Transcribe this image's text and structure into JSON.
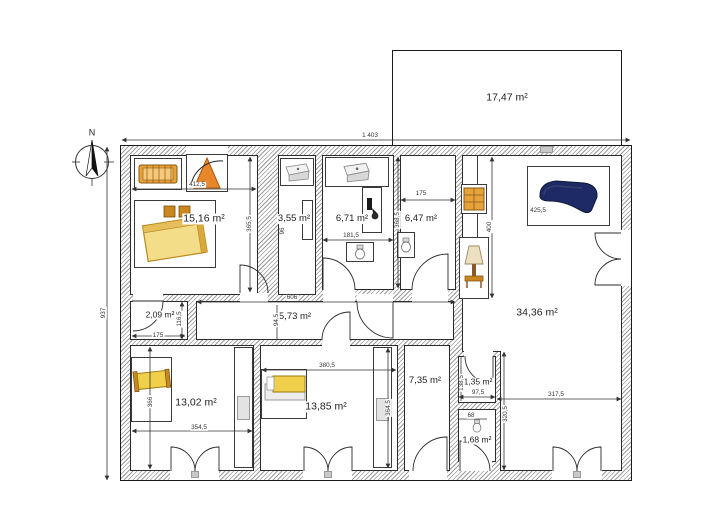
{
  "compass": {
    "north_label": "N"
  },
  "rooms": {
    "top_room": {
      "area": "17,47 m²"
    },
    "bedroom_main": {
      "area": "15,16 m²"
    },
    "closet": {
      "area": "3,55 m²"
    },
    "bathroom": {
      "area": "6,71 m²"
    },
    "wc": {
      "area": "6,47 m²"
    },
    "living_room": {
      "area": "34,36 m²"
    },
    "storage": {
      "area": "2,09 m²"
    },
    "hallway": {
      "area": "5,73 m²"
    },
    "bedroom_left": {
      "area": "13,02 m²"
    },
    "bedroom_mid": {
      "area": "13,85 m²"
    },
    "utility": {
      "area": "7,35 m²"
    },
    "wc_small": {
      "area": "1,35 m²"
    },
    "wc_tiny": {
      "area": "1,68 m²"
    }
  },
  "dimensions": {
    "total_width": "1 403",
    "total_height": "937",
    "bedroom_main_width": "412,5",
    "bedroom_main_height": "365,5",
    "closet_width": "96",
    "bathroom_width": "181,5",
    "wc_width": "175",
    "wc_height": "368,5",
    "sofa_width": "425,5",
    "corridor_length": "400",
    "hallway_length": "606",
    "hallway_height": "94,5",
    "storage_width": "175",
    "storage_height": "116,5",
    "bedroom_left_width": "354,5",
    "bedroom_left_height": "366",
    "bedroom_mid_width": "380,5",
    "bedroom_mid_height": "364,5",
    "wc_small_width": "97,5",
    "wc_small_height": "138,5",
    "wc_tiny_width": "68",
    "living_width": "317,5",
    "living_height": "320,5"
  },
  "icons": [
    "compass-rose",
    "crib",
    "french-door",
    "double-bed",
    "sink",
    "shower",
    "toilet",
    "shelf",
    "floor-lamp",
    "sofa",
    "single-bed",
    "wardrobe"
  ],
  "colors": {
    "sofa": "#1e2a66",
    "wood": "#c8871f",
    "bed_light": "#f3dd88",
    "bed_yellow": "#f0d04a",
    "crib": "#e8a23c",
    "door_orange": "#e8872a",
    "lamp_shade": "#ece0c0",
    "line": "#2b2b2b",
    "hatch": "#9b9b9b"
  }
}
